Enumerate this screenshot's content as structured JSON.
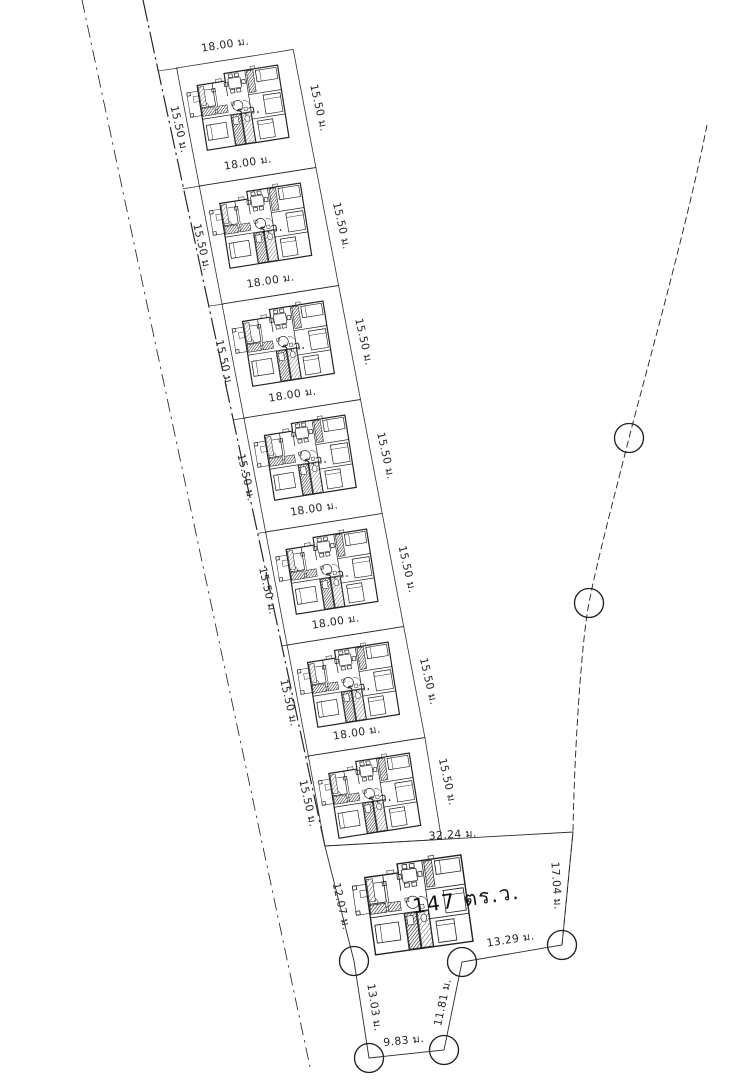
{
  "drawing_type": "site-plan",
  "colors": {
    "ink": "#212121",
    "background": "#ffffff"
  },
  "plots": [
    {
      "top_label": "18.00 ม.",
      "left_label": "15.50 ม.",
      "right_label": "15.50 ม.",
      "area_label": "ร.ว."
    },
    {
      "top_label": "18.00 ม.",
      "left_label": "15.50 ม.",
      "right_label": "15.50 ม.",
      "area_label": "ร.ว."
    },
    {
      "top_label": "18.00 ม.",
      "left_label": "15.50 ม.",
      "right_label": "15.50 ม.",
      "area_label": "ร.ว."
    },
    {
      "top_label": "18.00 ม.",
      "left_label": "15.50 ม.",
      "right_label": "15.50 ม.",
      "area_label": "ร.ว."
    },
    {
      "top_label": "18.00 ม.",
      "left_label": "15.50 ม.",
      "right_label": "15.50 ม.",
      "area_label": "ร.ว."
    },
    {
      "top_label": "18.00 ม.",
      "left_label": "15.50 ม.",
      "right_label": "15.50 ม.",
      "area_label": "ร.ว."
    },
    {
      "top_label": "18.00 ม.",
      "left_label": "15.50 ม.",
      "right_label": "15.50 ม.",
      "area_label": "ร.ว."
    }
  ],
  "large_plot": {
    "area_label": "147 ตร.ว.",
    "edge_labels": {
      "top": "32.24 ม.",
      "right": "17.04 ม.",
      "lower_right": "13.29 ม.",
      "inner_right": "11.81 ม.",
      "bottom": "9.83 ม.",
      "lower_left": "13.03 ม.",
      "left": "12.07 ม."
    }
  },
  "survey_markers": {
    "count": 7
  }
}
